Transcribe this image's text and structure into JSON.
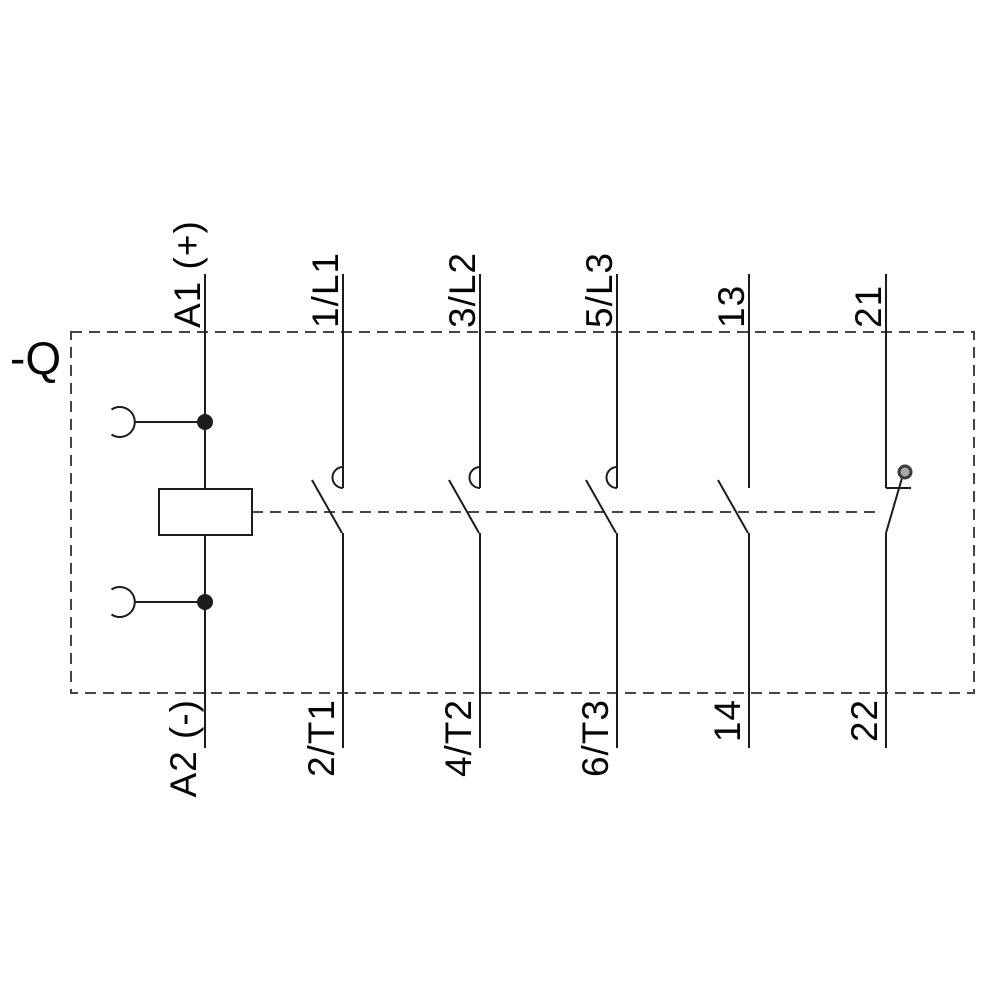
{
  "page": {
    "background": "#ffffff"
  },
  "diagram": {
    "designation": "-Q",
    "colors": {
      "line": "#1c1c1c",
      "dashed_line": "#454545",
      "text": "#060606",
      "pivot_fill": "#a8a8a8",
      "pivot_ring": "#3c3c3c"
    },
    "coil": {
      "top_label": "A1 (+)",
      "bottom_label": "A2 (-)"
    },
    "poles": [
      {
        "top_label": "1/L1",
        "bottom_label": "2/T1",
        "contact_type": "main-no-contact"
      },
      {
        "top_label": "3/L2",
        "bottom_label": "4/T2",
        "contact_type": "main-no-contact"
      },
      {
        "top_label": "5/L3",
        "bottom_label": "6/T3",
        "contact_type": "main-no-contact"
      },
      {
        "top_label": "13",
        "bottom_label": "14",
        "contact_type": "auxiliary-no-contact"
      },
      {
        "top_label": "21",
        "bottom_label": "22",
        "contact_type": "auxiliary-nc-contact"
      }
    ]
  }
}
